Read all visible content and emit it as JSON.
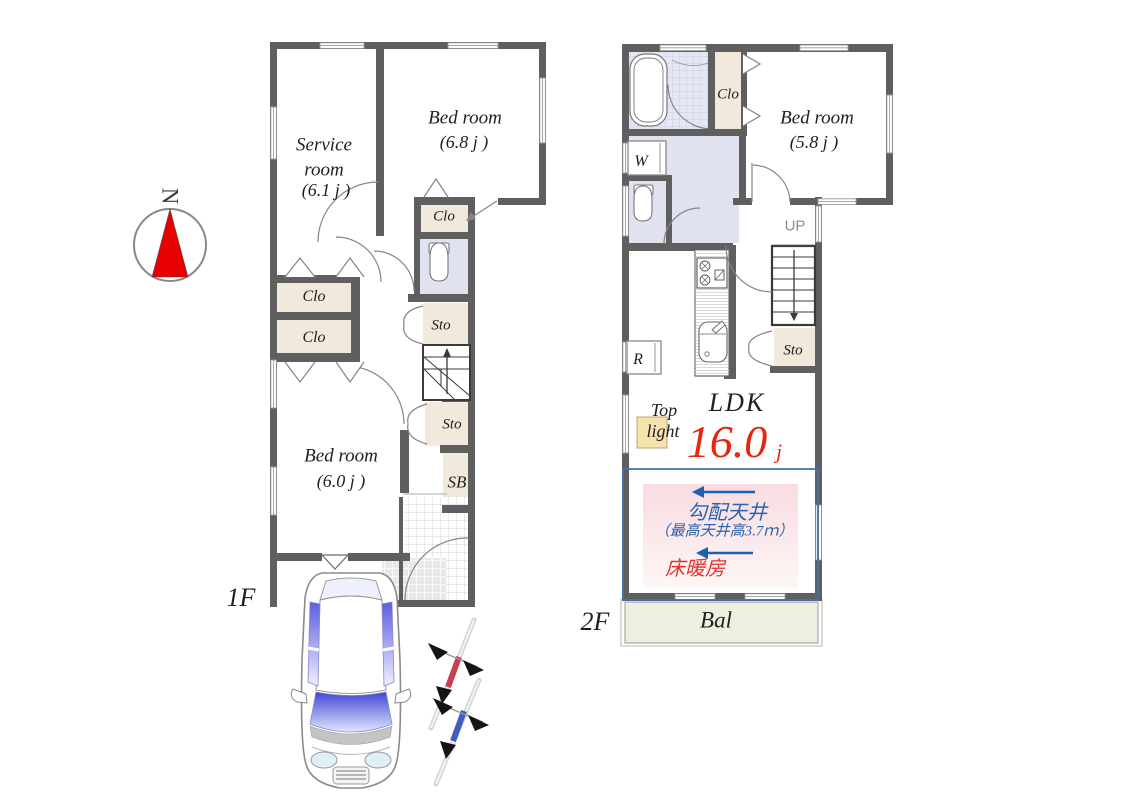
{
  "compass": {
    "n": "N"
  },
  "floor1": {
    "label": "1F",
    "service_room": {
      "line1": "Service",
      "line2": "room",
      "size": "(6.1 j )"
    },
    "bedroom_68": {
      "name": "Bed room",
      "size": "(6.8 j )"
    },
    "bedroom_60": {
      "name": "Bed room",
      "size": "(6.0 j )"
    },
    "closet_hall": "Clo",
    "closet_upper": "Clo",
    "closet_lower": "Clo",
    "storage_upper": "Sto",
    "storage_lower": "Sto",
    "shoe_box": "SB"
  },
  "floor2": {
    "label": "2F",
    "bedroom_58": {
      "name": "Bed room",
      "size": "(5.8 j )"
    },
    "closet": "Clo",
    "washer": "W",
    "fridge": "R",
    "stairs_up": "UP",
    "storage": "Sto",
    "ldk": {
      "name": "LDK",
      "size": "16.0",
      "unit": "j"
    },
    "top_light": {
      "line1": "Top",
      "line2": "light"
    },
    "sloped_ceiling": {
      "line1": "勾配天井",
      "line2": "（最高天井高3.7ｍ）",
      "line3": "床暖房"
    },
    "balcony": "Bal"
  },
  "colors": {
    "wall": "#5f5f5f",
    "closet_beige": "#f1e9db",
    "lavender": "#e0e2ef",
    "bath_blue": "#e4e8f4",
    "accent_red": "#e8250f",
    "accent_blue": "#2a64ae",
    "balcony_fill": "#eeeee1",
    "top_light_yellow": "#f6e2ad",
    "compass_red": "#e60000",
    "car_window_blue": "#5a5de0"
  }
}
